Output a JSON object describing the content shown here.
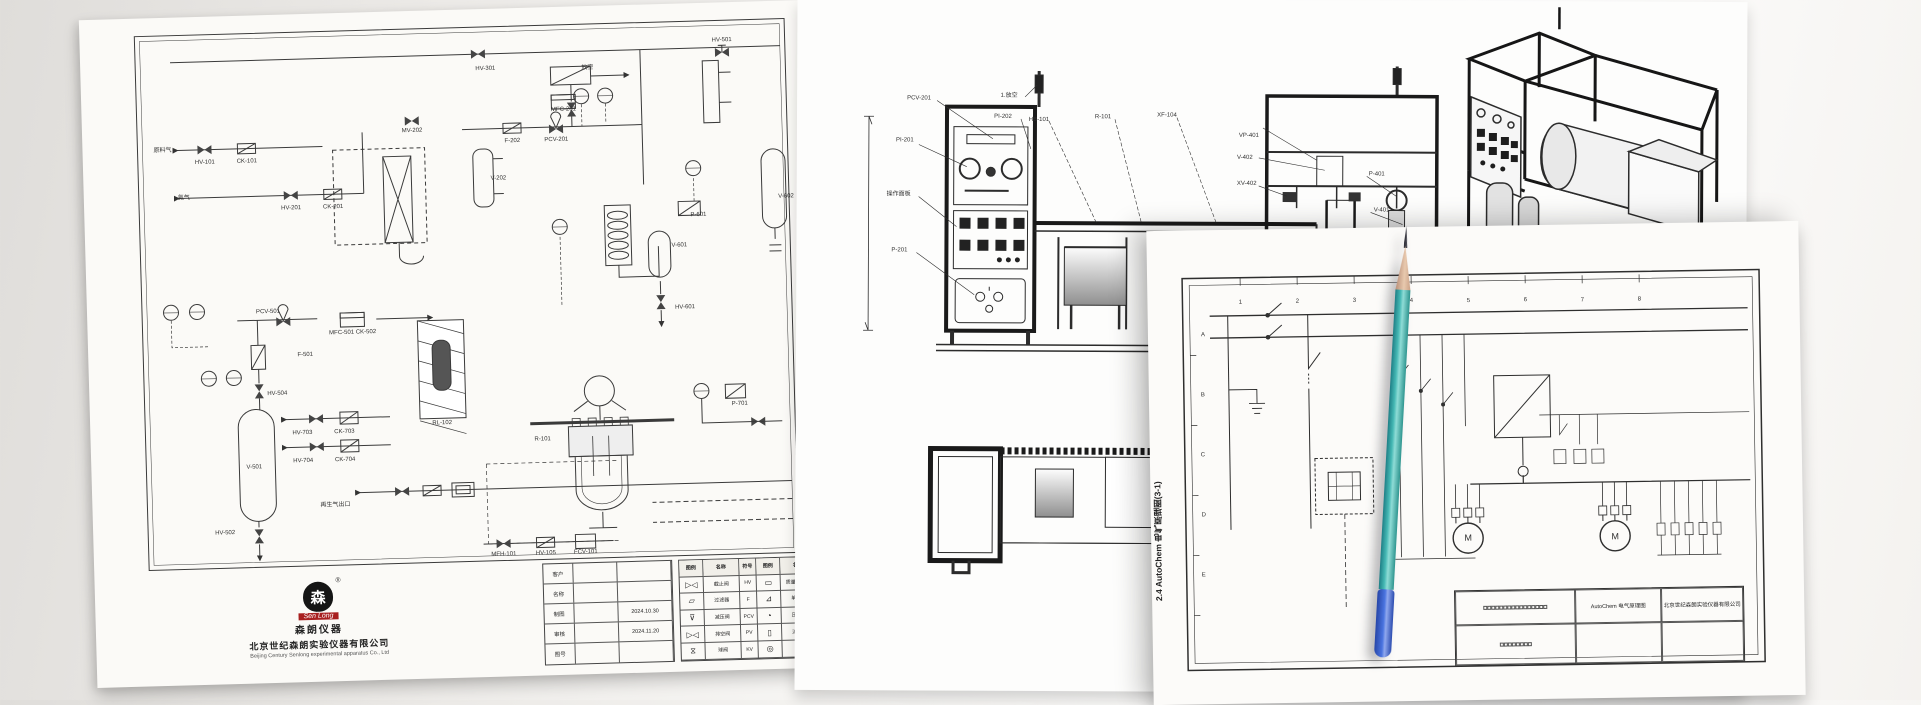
{
  "pid_sheet": {
    "company": {
      "logo_glyph": "森",
      "logo_text": "Sen Long",
      "reg_mark": "®",
      "brand_cn": "森朗仪器",
      "name_cn": "北京世纪森朗实验仪器有限公司",
      "name_en": "Beijing Century Senlong experimental apparatus Co., Ltd"
    },
    "title_fields": [
      {
        "label": "客户",
        "value": "",
        "date": ""
      },
      {
        "label": "名称",
        "value": "",
        "date": ""
      },
      {
        "label": "制图",
        "value": "",
        "date": "2024.10.30"
      },
      {
        "label": "审核",
        "value": "",
        "date": "2024.11.20"
      },
      {
        "label": "图号",
        "value": "",
        "date": ""
      }
    ],
    "legend": {
      "headers": [
        "图例",
        "名称",
        "符号",
        "图例",
        "名称",
        "符号",
        "图例",
        "名称"
      ],
      "rows": [
        [
          "▷◁",
          "截止阀",
          "HV",
          "▭",
          "质量流量计",
          "MFC",
          "⌖",
          "压力传感器"
        ],
        [
          "▱",
          "过滤器",
          "F",
          "⊿",
          "单向阀",
          "CK",
          "⊠",
          "安全阀"
        ],
        [
          "⊽",
          "减压阀",
          "PCV",
          "◔",
          "压力表",
          "PI",
          "▤",
          "冷凝器"
        ],
        [
          "▷◁",
          "排空阀",
          "PV",
          "▯",
          "流量计",
          "FI",
          "▨",
          "加热炉"
        ],
        [
          "⧖",
          "球阀",
          "KV",
          "◎",
          "泵",
          "P",
          "◉",
          "电机"
        ]
      ]
    },
    "tags": [
      {
        "t": "HV-301",
        "x": 405,
        "y": 60
      },
      {
        "t": "放空",
        "x": 507,
        "y": 62
      },
      {
        "t": "HV-501",
        "x": 642,
        "y": 38
      },
      {
        "t": "MFC-201",
        "x": 482,
        "y": 103
      },
      {
        "t": "PCV-201",
        "x": 474,
        "y": 133
      },
      {
        "t": "F-202",
        "x": 430,
        "y": 133
      },
      {
        "t": "MV-202",
        "x": 330,
        "y": 120
      },
      {
        "t": "V-202",
        "x": 415,
        "y": 170
      },
      {
        "t": "原料气",
        "x": 80,
        "y": 133
      },
      {
        "t": "HV-101",
        "x": 122,
        "y": 146
      },
      {
        "t": "CK-101",
        "x": 164,
        "y": 146
      },
      {
        "t": "氮气",
        "x": 100,
        "y": 181
      },
      {
        "t": "HV-201",
        "x": 207,
        "y": 194
      },
      {
        "t": "CK-201",
        "x": 249,
        "y": 194
      },
      {
        "t": "PCV-501",
        "x": 181,
        "y": 297
      },
      {
        "t": "MFC-501 CK-502",
        "x": 265,
        "y": 320
      },
      {
        "t": "F-501",
        "x": 217,
        "y": 341
      },
      {
        "t": "HV-504",
        "x": 188,
        "y": 379
      },
      {
        "t": "RL-102",
        "x": 352,
        "y": 413
      },
      {
        "t": "V-501",
        "x": 163,
        "y": 452
      },
      {
        "t": "HV-502",
        "x": 132,
        "y": 517
      },
      {
        "t": "HV-703",
        "x": 212,
        "y": 419
      },
      {
        "t": "CK-703",
        "x": 254,
        "y": 419
      },
      {
        "t": "HV-704",
        "x": 212,
        "y": 447
      },
      {
        "t": "CK-704",
        "x": 254,
        "y": 447
      },
      {
        "t": "再生气出口",
        "x": 243,
        "y": 492
      },
      {
        "t": "R-101",
        "x": 452,
        "y": 432
      },
      {
        "t": "P-601",
        "x": 614,
        "y": 212
      },
      {
        "t": "V-601",
        "x": 594,
        "y": 242
      },
      {
        "t": "HV-601",
        "x": 598,
        "y": 304
      },
      {
        "t": "V-602",
        "x": 702,
        "y": 196
      },
      {
        "t": "P-701",
        "x": 650,
        "y": 402
      },
      {
        "t": "MFH-101",
        "x": 410,
        "y": 546
      },
      {
        "t": "HV-105",
        "x": 452,
        "y": 546
      },
      {
        "t": "FCV-101",
        "x": 492,
        "y": 546
      }
    ]
  },
  "elevation_sheet": {
    "tags": [
      {
        "t": "PCV-201",
        "x": 122,
        "y": 100
      },
      {
        "t": "PI-201",
        "x": 108,
        "y": 142
      },
      {
        "t": "操作面板",
        "x": 102,
        "y": 196
      },
      {
        "t": "P-201",
        "x": 103,
        "y": 252
      },
      {
        "t": "1.放空",
        "x": 212,
        "y": 97
      },
      {
        "t": "PI-202",
        "x": 206,
        "y": 118
      },
      {
        "t": "HB-101",
        "x": 242,
        "y": 121
      },
      {
        "t": "R-101",
        "x": 306,
        "y": 118
      },
      {
        "t": "XF-104",
        "x": 370,
        "y": 116
      },
      {
        "t": "VP-401",
        "x": 452,
        "y": 136
      },
      {
        "t": "V-402",
        "x": 448,
        "y": 158
      },
      {
        "t": "XV-402",
        "x": 450,
        "y": 184
      },
      {
        "t": "P-401",
        "x": 580,
        "y": 174
      },
      {
        "t": "V-401",
        "x": 585,
        "y": 210
      }
    ]
  },
  "electrical_sheet": {
    "vertical_title": "2.4 AutoChem 电气原理图(3-1)",
    "grid_cols": [
      "1",
      "2",
      "3",
      "4",
      "5",
      "6",
      "7",
      "8"
    ],
    "grid_rows": [
      "A",
      "B",
      "C",
      "D",
      "E"
    ],
    "title_block": {
      "drawing_name": "AutoChem 电气原理图",
      "company": "北京世纪森朗实验仪器有限公司"
    },
    "tags": [
      {
        "t": "1",
        "x": 93,
        "y": 73
      },
      {
        "t": "2",
        "x": 150,
        "y": 73
      },
      {
        "t": "3",
        "x": 207,
        "y": 73
      },
      {
        "t": "4",
        "x": 264,
        "y": 74
      },
      {
        "t": "5",
        "x": 321,
        "y": 75
      },
      {
        "t": "6",
        "x": 378,
        "y": 75
      },
      {
        "t": "7",
        "x": 435,
        "y": 76
      },
      {
        "t": "8",
        "x": 492,
        "y": 76
      },
      {
        "t": "A",
        "x": 55,
        "y": 105
      },
      {
        "t": "B",
        "x": 54,
        "y": 165
      },
      {
        "t": "C",
        "x": 53,
        "y": 225
      },
      {
        "t": "D",
        "x": 53,
        "y": 285
      },
      {
        "t": "E",
        "x": 52,
        "y": 345
      },
      {
        "t": "M",
        "x": 317,
        "y": 312,
        "s": 9
      },
      {
        "t": "M",
        "x": 464,
        "y": 313,
        "s": 9
      }
    ]
  }
}
